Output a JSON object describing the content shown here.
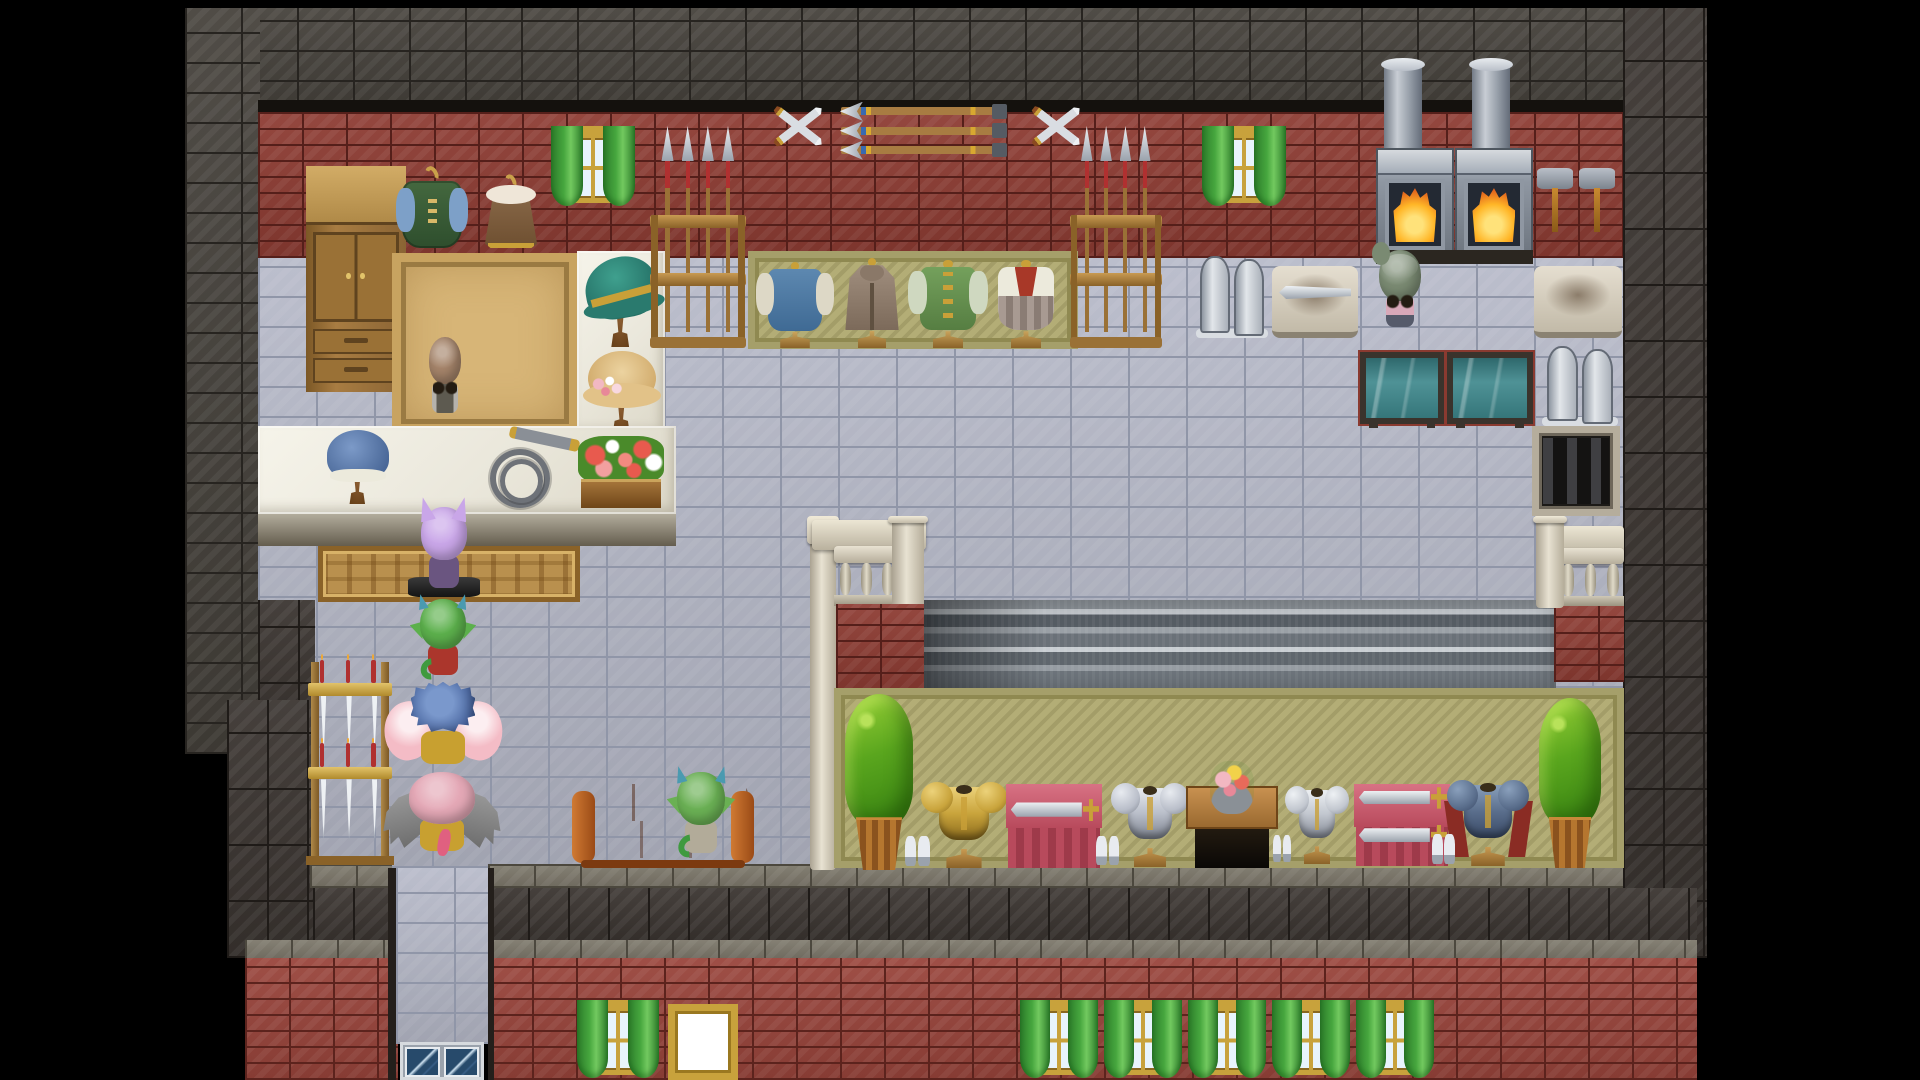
{
  "scene": {
    "width": 1920,
    "height": 1080,
    "style": "pixel-rpg-tilemap",
    "location": "blacksmith-outfitter-shop-interior"
  },
  "materials": {
    "stone": {
      "base": "#45413b",
      "grout": "#272420",
      "bw": 56,
      "rh": 30
    },
    "dark": {
      "base": "#3a3430",
      "grout": "#1f1b18",
      "bw": 40,
      "rh": 56
    },
    "brick": {
      "base": "#8e3c33",
      "grout": "#551f1a",
      "bw": 44,
      "rh": 16
    },
    "brickB": {
      "base": "#99443b",
      "grout": "#5c231d",
      "bw": 44,
      "rh": 16
    },
    "tile": {
      "base": "#b7bac9",
      "grout": "#9096a8",
      "bw": 58,
      "rh": 30
    },
    "ledge": {
      "base": "#7d786b",
      "grout": "#4c483e",
      "bw": 46,
      "rh": 22
    }
  },
  "colors": {
    "void": "#000000",
    "frameGold": "#c8a23c",
    "paneBlue": "#e8f4fc",
    "curtain": "#46a63e",
    "curtainDark": "#2c7c2a",
    "counterTop": "#eae7db",
    "counterHi": "#f6f4ea",
    "counterFront": "#b2ac9c",
    "counterFrontDark": "#645d4e",
    "tanMat": "#b9904e",
    "tanBorder": "#8a6228",
    "olive": "#b3ad76",
    "oliveDark": "#8f8951",
    "gold": "#c9a038",
    "white": "#ffffff",
    "signFrame": "#c8a23c",
    "glass": "#274a6b",
    "glassHi": "#cfe3f2",
    "fireCore": "#ffe27a",
    "fire": "#ffb627",
    "fireDeep": "#e2641c",
    "tankFrame": "#3a332c",
    "couch": "#b3591f",
    "couchDark": "#7c3a10",
    "couchHi": "#d07a33",
    "shirt": "#b5b2ac",
    "apron": "#5d5a50",
    "pinkTop": "#d8a8b8"
  },
  "entities": [
    {
      "n": "letterbox",
      "k": "region",
      "x": 0,
      "y": 0,
      "w": 1920,
      "h": 1080,
      "i": false,
      "fill": "#000000"
    },
    {
      "n": "outer-wall-top",
      "k": "region",
      "x": 185,
      "y": 8,
      "w": 1438,
      "h": 104,
      "i": false,
      "mat": "stone"
    },
    {
      "n": "outer-wall-right",
      "k": "region",
      "x": 1623,
      "y": 8,
      "w": 84,
      "h": 950,
      "i": false,
      "mat": "dark"
    },
    {
      "n": "outer-wall-left",
      "k": "region",
      "x": 185,
      "y": 8,
      "w": 75,
      "h": 746,
      "i": false,
      "mat": "stone"
    },
    {
      "n": "wall-ledge-line",
      "k": "region",
      "x": 258,
      "y": 100,
      "w": 1365,
      "h": 14,
      "i": false,
      "fill": "#14110d"
    },
    {
      "n": "shop-back-wall",
      "k": "region",
      "x": 258,
      "y": 112,
      "w": 1365,
      "h": 146,
      "i": false,
      "mat": "brick"
    },
    {
      "n": "shop-floor",
      "k": "region",
      "x": 258,
      "y": 258,
      "w": 1365,
      "h": 610,
      "i": false,
      "mat": "tile"
    },
    {
      "n": "left-wall-lower",
      "k": "region",
      "x": 258,
      "y": 600,
      "w": 57,
      "h": 140,
      "i": false,
      "mat": "dark"
    },
    {
      "n": "left-wall-corner",
      "k": "region",
      "x": 227,
      "y": 700,
      "w": 88,
      "h": 258,
      "i": false,
      "mat": "dark"
    },
    {
      "n": "facade-band-left",
      "k": "region",
      "x": 313,
      "y": 886,
      "w": 85,
      "h": 56,
      "i": false,
      "mat": "dark"
    },
    {
      "n": "ledge-left",
      "k": "region",
      "x": 310,
      "y": 864,
      "w": 82,
      "h": 24,
      "i": false,
      "mat": "ledge"
    },
    {
      "n": "ledge-main",
      "k": "region",
      "x": 488,
      "y": 864,
      "w": 1135,
      "h": 24,
      "i": false,
      "mat": "ledge"
    },
    {
      "n": "facade-band",
      "k": "region",
      "x": 488,
      "y": 888,
      "w": 1209,
      "h": 54,
      "i": false,
      "mat": "dark"
    },
    {
      "n": "ledge-bottom-left",
      "k": "region",
      "x": 245,
      "y": 940,
      "w": 153,
      "h": 20,
      "i": false,
      "mat": "ledge"
    },
    {
      "n": "ledge-bottom-right",
      "k": "region",
      "x": 488,
      "y": 940,
      "w": 1209,
      "h": 20,
      "i": false,
      "mat": "ledge"
    },
    {
      "n": "facade-brick-left",
      "k": "region",
      "x": 245,
      "y": 958,
      "w": 153,
      "h": 122,
      "i": false,
      "mat": "brickB"
    },
    {
      "n": "facade-brick-right",
      "k": "region",
      "x": 488,
      "y": 958,
      "w": 1209,
      "h": 122,
      "i": false,
      "mat": "brickB"
    },
    {
      "n": "entry-passage",
      "k": "region",
      "x": 396,
      "y": 868,
      "w": 92,
      "h": 176,
      "i": false,
      "mat": "tile"
    },
    {
      "n": "passage-edge-left",
      "k": "region",
      "x": 388,
      "y": 868,
      "w": 8,
      "h": 212,
      "i": false,
      "fill": "#241f1b"
    },
    {
      "n": "passage-edge-right",
      "k": "region",
      "x": 488,
      "y": 868,
      "w": 6,
      "h": 212,
      "i": false,
      "fill": "#241f1b"
    },
    {
      "n": "entry-glass-door",
      "k": "glassdoor",
      "x": 400,
      "y": 1042,
      "w": 84,
      "h": 38,
      "i": true
    },
    {
      "n": "wardrobe-cabinet",
      "k": "cabinet",
      "x": 306,
      "y": 166,
      "w": 100,
      "h": 226,
      "i": true
    },
    {
      "n": "shop-rug",
      "k": "rug",
      "x": 392,
      "y": 253,
      "w": 186,
      "h": 180,
      "i": false
    },
    {
      "n": "hat-display-counter",
      "k": "counter",
      "x": 577,
      "y": 251,
      "w": 88,
      "h": 184,
      "i": false
    },
    {
      "n": "witch-hat-display",
      "k": "hat",
      "v": "witch",
      "x": 582,
      "y": 255,
      "w": 78,
      "h": 92,
      "i": true
    },
    {
      "n": "straw-hat-display",
      "k": "hat",
      "v": "straw",
      "x": 585,
      "y": 349,
      "w": 74,
      "h": 84,
      "i": true
    },
    {
      "n": "shop-counter",
      "k": "counter",
      "x": 258,
      "y": 426,
      "w": 418,
      "h": 88,
      "i": false
    },
    {
      "n": "shop-counter-front",
      "k": "counterfront",
      "x": 258,
      "y": 514,
      "w": 418,
      "h": 32,
      "i": false
    },
    {
      "n": "counter-doormat",
      "k": "tanmat",
      "x": 318,
      "y": 546,
      "w": 262,
      "h": 56,
      "i": false
    },
    {
      "n": "bonnet-hat-display",
      "k": "hat",
      "v": "bonnet",
      "x": 324,
      "y": 428,
      "w": 68,
      "h": 76,
      "i": true
    },
    {
      "n": "coiled-whip-display",
      "k": "whip",
      "x": 486,
      "y": 430,
      "w": 94,
      "h": 78,
      "i": true
    },
    {
      "n": "flower-box",
      "k": "flowerbox",
      "x": 578,
      "y": 436,
      "w": 86,
      "h": 72,
      "i": false
    },
    {
      "n": "npc-shopkeeper",
      "k": "npc",
      "v": "shopkeeper",
      "x": 418,
      "y": 334,
      "w": 54,
      "h": 86,
      "i": true,
      "vars": {
        "--hair": "#a5846a",
        "--bodyc": "#b5b2ac"
      }
    },
    {
      "n": "apparel-display-mat",
      "k": "olivemat",
      "x": 748,
      "y": 251,
      "w": 330,
      "h": 98,
      "i": false
    },
    {
      "n": "mannequin-blue-tunic",
      "k": "mannequin",
      "v": "tunic",
      "x": 758,
      "y": 262,
      "w": 74,
      "h": 86,
      "i": true
    },
    {
      "n": "mannequin-travel-cloak",
      "k": "mannequin",
      "v": "cloak",
      "x": 836,
      "y": 258,
      "w": 72,
      "h": 90,
      "i": true
    },
    {
      "n": "mannequin-green-coat",
      "k": "mannequin",
      "v": "coatg",
      "x": 910,
      "y": 260,
      "w": 76,
      "h": 88,
      "i": true
    },
    {
      "n": "mannequin-white-dress",
      "k": "mannequin",
      "v": "dress",
      "x": 988,
      "y": 260,
      "w": 76,
      "h": 88,
      "i": true
    },
    {
      "n": "spear-rack-left",
      "k": "spearrack",
      "x": 650,
      "y": 126,
      "w": 96,
      "h": 222,
      "i": true
    },
    {
      "n": "spear-rack-right",
      "k": "spearrack",
      "x": 1070,
      "y": 126,
      "w": 92,
      "h": 222,
      "i": true
    },
    {
      "n": "hanging-vest",
      "k": "coat",
      "v": "vest",
      "x": 396,
      "y": 166,
      "w": 72,
      "h": 84,
      "i": true
    },
    {
      "n": "hanging-fur-coat",
      "k": "coat",
      "v": "fur",
      "x": 480,
      "y": 174,
      "w": 62,
      "h": 76,
      "i": true
    },
    {
      "n": "window-upper-left",
      "k": "window",
      "x": 551,
      "y": 126,
      "w": 84,
      "h": 82,
      "i": false
    },
    {
      "n": "crossed-swords-left",
      "k": "xswords",
      "x": 766,
      "y": 96,
      "w": 64,
      "h": 62,
      "i": false
    },
    {
      "n": "arrow-display",
      "k": "arrows",
      "x": 838,
      "y": 104,
      "w": 172,
      "h": 54,
      "i": false
    },
    {
      "n": "crossed-swords-right",
      "k": "xswords",
      "x": 1024,
      "y": 96,
      "w": 64,
      "h": 62,
      "i": false
    },
    {
      "n": "window-upper-right",
      "k": "window",
      "x": 1202,
      "y": 126,
      "w": 84,
      "h": 82,
      "i": false
    },
    {
      "n": "forge-chimney-left",
      "k": "chimney",
      "x": 1384,
      "y": 60,
      "w": 38,
      "h": 102,
      "i": false
    },
    {
      "n": "forge-chimney-right",
      "k": "chimney",
      "x": 1472,
      "y": 60,
      "w": 38,
      "h": 102,
      "i": false
    },
    {
      "n": "forge-left",
      "k": "forge",
      "x": 1376,
      "y": 148,
      "w": 78,
      "h": 108,
      "i": false
    },
    {
      "n": "forge-right",
      "k": "forge",
      "x": 1455,
      "y": 148,
      "w": 78,
      "h": 108,
      "i": false
    },
    {
      "n": "forge-counter",
      "k": "region",
      "x": 1376,
      "y": 250,
      "w": 157,
      "h": 14,
      "i": false,
      "fill": "#2b2620"
    },
    {
      "n": "wall-hammers",
      "k": "hammers",
      "x": 1534,
      "y": 164,
      "w": 84,
      "h": 74,
      "i": false
    },
    {
      "n": "metal-stock-left",
      "k": "slab",
      "x": 1196,
      "y": 254,
      "w": 72,
      "h": 84,
      "i": false
    },
    {
      "n": "workbench-blade",
      "k": "bench",
      "v": "blade",
      "x": 1272,
      "y": 266,
      "w": 86,
      "h": 72,
      "i": false
    },
    {
      "n": "npc-blacksmith",
      "k": "npc",
      "v": "smith",
      "x": 1371,
      "y": 246,
      "w": 58,
      "h": 88,
      "i": true,
      "vars": {
        "--hair": "#7a8a72",
        "--bodyc": "#d8a8b8"
      }
    },
    {
      "n": "workbench-right",
      "k": "bench",
      "x": 1534,
      "y": 266,
      "w": 88,
      "h": 72,
      "i": false
    },
    {
      "n": "quench-tank-left",
      "k": "tank",
      "x": 1360,
      "y": 352,
      "w": 84,
      "h": 72,
      "i": false
    },
    {
      "n": "quench-tank-right",
      "k": "tank",
      "x": 1447,
      "y": 352,
      "w": 86,
      "h": 72,
      "i": false
    },
    {
      "n": "metal-stock-right",
      "k": "slab",
      "x": 1542,
      "y": 344,
      "w": 76,
      "h": 82,
      "i": false
    },
    {
      "n": "floor-grate",
      "k": "grate",
      "x": 1532,
      "y": 426,
      "w": 88,
      "h": 90,
      "i": false
    },
    {
      "n": "stair-pillar-left",
      "k": "pillar",
      "x": 810,
      "y": 516,
      "w": 26,
      "h": 354,
      "i": false
    },
    {
      "n": "stair-rail-top-left",
      "k": "railtop",
      "x": 812,
      "y": 520,
      "w": 114,
      "h": 30,
      "i": false
    },
    {
      "n": "stair-balustrade-left",
      "k": "balustrade",
      "x": 834,
      "y": 546,
      "w": 64,
      "h": 60,
      "i": false
    },
    {
      "n": "stair-pillar-mid",
      "k": "pillar",
      "x": 892,
      "y": 516,
      "w": 32,
      "h": 92,
      "i": false
    },
    {
      "n": "stair-brick-left",
      "k": "region",
      "x": 836,
      "y": 604,
      "w": 88,
      "h": 86,
      "i": false,
      "mat": "brick"
    },
    {
      "n": "stair-steps",
      "k": "steps",
      "x": 924,
      "y": 600,
      "w": 632,
      "h": 90,
      "i": false
    },
    {
      "n": "steps-shadow",
      "k": "shadow",
      "x": 924,
      "y": 600,
      "w": 120,
      "h": 90,
      "i": false
    },
    {
      "n": "stair-brick-right",
      "k": "region",
      "x": 1554,
      "y": 604,
      "w": 70,
      "h": 78,
      "i": false,
      "mat": "brick"
    },
    {
      "n": "stair-rail-top-right",
      "k": "railtop",
      "x": 1540,
      "y": 526,
      "w": 84,
      "h": 30,
      "i": false
    },
    {
      "n": "stair-balustrade-right",
      "k": "balustrade",
      "x": 1556,
      "y": 548,
      "w": 68,
      "h": 58,
      "i": false
    },
    {
      "n": "stair-pillar-right",
      "k": "pillar",
      "x": 1536,
      "y": 516,
      "w": 28,
      "h": 92,
      "i": false
    },
    {
      "n": "armor-display-mat",
      "k": "olivemat",
      "x": 834,
      "y": 688,
      "w": 790,
      "h": 180,
      "i": false
    },
    {
      "n": "potted-plant-left",
      "k": "plant",
      "x": 842,
      "y": 694,
      "w": 74,
      "h": 176,
      "i": false
    },
    {
      "n": "armor-stand-gold",
      "k": "armor",
      "v": "gold",
      "x": 920,
      "y": 780,
      "w": 88,
      "h": 88,
      "i": true,
      "vars": {
        "--m": "#c9a43c",
        "--mhi": "#ecd27a",
        "--md": "#8a6a1c"
      }
    },
    {
      "n": "sword-table-single",
      "k": "dtable",
      "v": "red1",
      "x": 1006,
      "y": 784,
      "w": 96,
      "h": 84,
      "i": true
    },
    {
      "n": "armor-stand-silver",
      "k": "armor",
      "v": "silver",
      "x": 1110,
      "y": 781,
      "w": 80,
      "h": 86,
      "i": true,
      "vars": {
        "--m": "#b9bec9",
        "--mhi": "#e8ebf0",
        "--md": "#7c828e"
      }
    },
    {
      "n": "flower-table",
      "k": "dtable",
      "v": "woodf",
      "x": 1186,
      "y": 786,
      "w": 92,
      "h": 82,
      "i": true
    },
    {
      "n": "armor-stand-plate",
      "k": "armor",
      "v": "silver",
      "x": 1284,
      "y": 784,
      "w": 66,
      "h": 80,
      "i": true,
      "vars": {
        "--m": "#c2c7cf",
        "--mhi": "#eef1f4",
        "--md": "#848a96"
      }
    },
    {
      "n": "sword-table-double",
      "k": "dtable",
      "v": "red2",
      "x": 1354,
      "y": 784,
      "w": 96,
      "h": 82,
      "i": true
    },
    {
      "n": "armor-stand-blue",
      "k": "armor",
      "v": "blue",
      "x": 1446,
      "y": 778,
      "w": 84,
      "h": 88,
      "i": true,
      "vars": {
        "--m": "#5a6e8c",
        "--mhi": "#8aa0bc",
        "--md": "#3a4a66"
      }
    },
    {
      "n": "potted-plant-right",
      "k": "plant",
      "x": 1536,
      "y": 698,
      "w": 68,
      "h": 170,
      "i": false
    },
    {
      "n": "sword-rack-tiered",
      "k": "swordrack2",
      "x": 306,
      "y": 651,
      "w": 88,
      "h": 214,
      "i": true
    },
    {
      "n": "npc-purple-customer",
      "k": "npc",
      "v": "purple",
      "x": 412,
      "y": 503,
      "w": 64,
      "h": 92,
      "i": true,
      "vars": {
        "--hair": "#c9a6e8",
        "--bodyc": "#6a5580"
      }
    },
    {
      "n": "npc-demon-customer",
      "k": "npc",
      "v": "demon",
      "x": 411,
      "y": 596,
      "w": 64,
      "h": 86,
      "i": true,
      "vars": {
        "--hair": "#5cb04c",
        "--bodyc": "#ab362c"
      }
    },
    {
      "n": "npc-fairy-customer",
      "k": "npc",
      "v": "fairy",
      "x": 398,
      "y": 678,
      "w": 90,
      "h": 94,
      "i": true,
      "vars": {
        "--hair": "#5577b5",
        "--bodyc": "#c8a030",
        "--wing": "#f4bcc6"
      }
    },
    {
      "n": "npc-winged-customer",
      "k": "npc",
      "v": "batgirl",
      "x": 396,
      "y": 768,
      "w": 92,
      "h": 90,
      "i": true,
      "vars": {
        "--hair": "#e4a8b6",
        "--bodyc": "#c8a030",
        "--wing": "#8e8e8e"
      }
    },
    {
      "n": "shop-couch",
      "k": "couch",
      "x": 574,
      "y": 784,
      "w": 178,
      "h": 84,
      "i": true
    },
    {
      "n": "npc-goblin-customer",
      "k": "npc",
      "v": "goblin",
      "x": 668,
      "y": 768,
      "w": 66,
      "h": 92,
      "i": true,
      "vars": {
        "--hair": "#6ab054",
        "--bodyc": "#b2ab99"
      }
    },
    {
      "n": "window-lower-left",
      "k": "window",
      "x": 577,
      "y": 1000,
      "w": 82,
      "h": 80,
      "i": false
    },
    {
      "n": "shop-sign-board",
      "k": "sign",
      "x": 668,
      "y": 1004,
      "w": 70,
      "h": 76,
      "i": false
    },
    {
      "n": "window-lower-1",
      "k": "window",
      "x": 1020,
      "y": 1000,
      "w": 78,
      "h": 80,
      "i": false
    },
    {
      "n": "window-lower-2",
      "k": "window",
      "x": 1104,
      "y": 1000,
      "w": 78,
      "h": 80,
      "i": false
    },
    {
      "n": "window-lower-3",
      "k": "window",
      "x": 1188,
      "y": 1000,
      "w": 78,
      "h": 80,
      "i": false
    },
    {
      "n": "window-lower-4",
      "k": "window",
      "x": 1272,
      "y": 1000,
      "w": 78,
      "h": 80,
      "i": false
    },
    {
      "n": "window-lower-5",
      "k": "window",
      "x": 1356,
      "y": 1000,
      "w": 78,
      "h": 80,
      "i": false
    }
  ]
}
